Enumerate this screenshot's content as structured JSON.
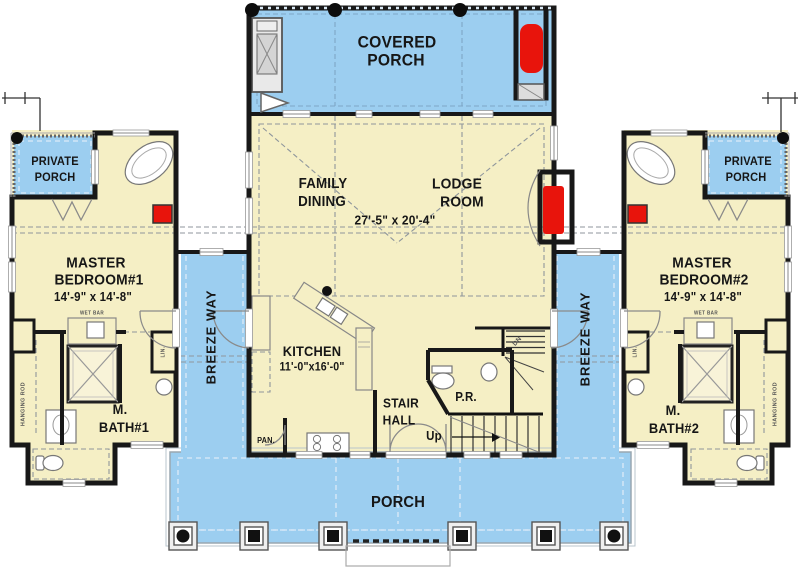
{
  "colors": {
    "porch_blue": "#9CCEF0",
    "floor_cream": "#F5EFC5",
    "fireplace_red": "#E8140C",
    "wall_black": "#181818"
  },
  "rooms": {
    "covered_porch": {
      "line1": "COVERED",
      "line2": "PORCH"
    },
    "great_room": {
      "left1": "FAMILY",
      "left2": "DINING",
      "right1": "LODGE",
      "right2": "ROOM",
      "dim": "27'-5\" x 20'-4\""
    },
    "kitchen": {
      "name": "KITCHEN",
      "dim": "11'-0\"x16'-0\""
    },
    "stair_hall": {
      "line1": "STAIR",
      "line2": "HALL"
    },
    "powder_room": {
      "abbr": "P.R."
    },
    "pantry": {
      "abbr": "PAN."
    },
    "stairs": {
      "up": "Up",
      "down": "DN"
    },
    "master_bedroom_1": {
      "line1": "MASTER",
      "line2": "BEDROOM#1",
      "dim": "14'-9\" x 14'-8\""
    },
    "master_bath_1": {
      "line1": "M.",
      "line2": "BATH#1"
    },
    "private_porch_left": {
      "line1": "PRIVATE",
      "line2": "PORCH"
    },
    "master_bedroom_2": {
      "line1": "MASTER",
      "line2": "BEDROOM#2",
      "dim": "14'-9\" x 14'-8\""
    },
    "master_bath_2": {
      "line1": "M.",
      "line2": "BATH#2"
    },
    "private_porch_right": {
      "line1": "PRIVATE",
      "line2": "PORCH"
    },
    "breezeway_left": {
      "label": "BREEZE WAY"
    },
    "breezeway_right": {
      "label": "BREEZE WAY"
    },
    "front_porch": {
      "label": "PORCH"
    }
  },
  "fixture_labels": {
    "hanging_rod_left": "HANGING ROD",
    "hanging_rod_right": "HANGING ROD",
    "linen_left": "LIN.",
    "linen_right": "LIN.",
    "wet_bar_left": "WET BAR",
    "wet_bar_right": "WET BAR"
  }
}
